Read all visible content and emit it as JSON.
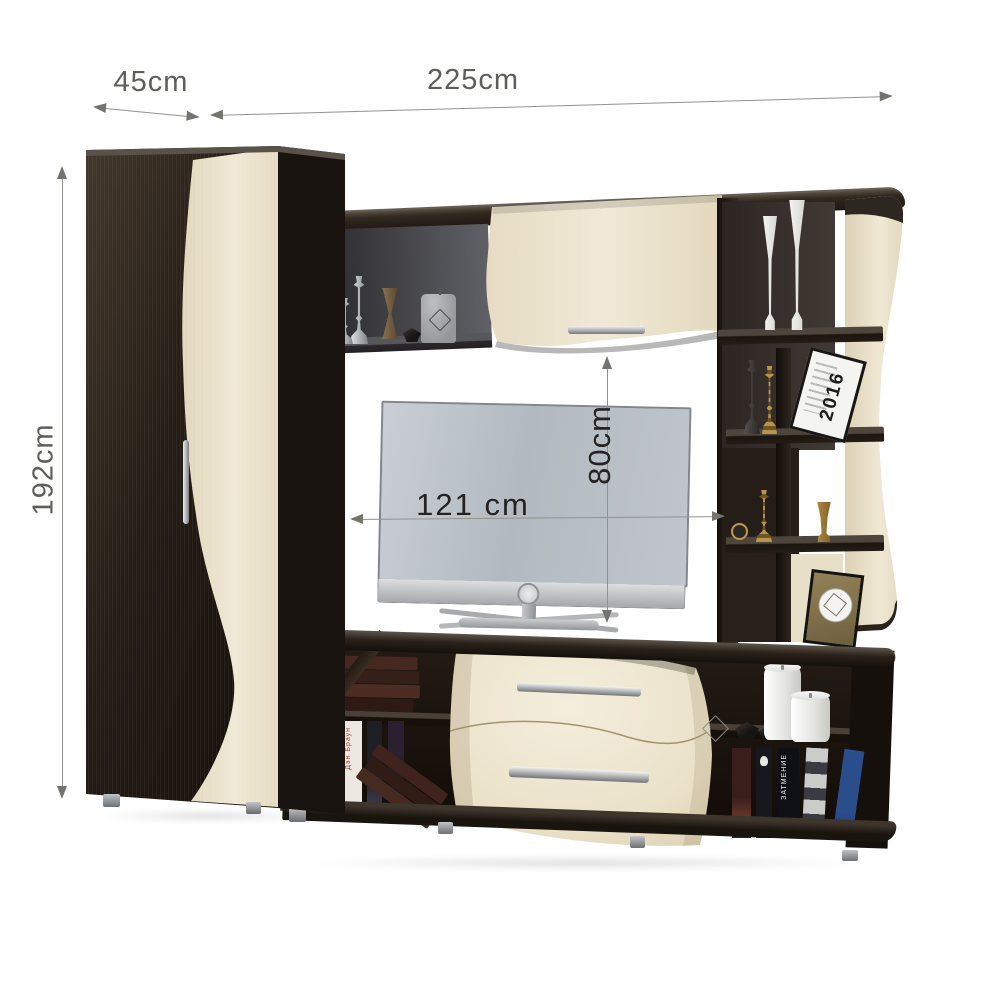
{
  "page": {
    "background": "#ffffff",
    "description": "Product photo of a two-tone wenge and maple living-room wall unit with TV, annotated with overall and niche dimensions"
  },
  "dimensions": {
    "depth": {
      "label": "45cm"
    },
    "width": {
      "label": "225cm"
    },
    "height": {
      "label": "192cm"
    },
    "tv_niche_width": {
      "label": "121 cm"
    },
    "tv_niche_height": {
      "label": "80cm"
    }
  },
  "decor": {
    "calendar_year": "2016",
    "book_title_right": "ЗАТМЕНИЕ",
    "book_title_left": "Дэн Браун"
  },
  "colors": {
    "wenge_dark": "#1e1712",
    "maple_cream": "#ebe2cc",
    "dimension_line": "#92928e",
    "dimension_text_top": "#5e5e5a",
    "dimension_text_tv": "#232321",
    "tv_silver": "#bcc2c8"
  }
}
